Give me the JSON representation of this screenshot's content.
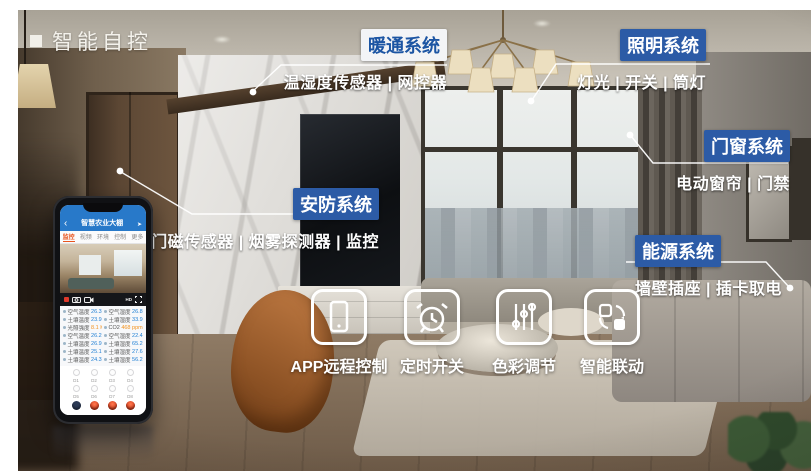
{
  "title": {
    "text": "智能自控"
  },
  "systems": [
    {
      "name": "暖通系统",
      "items": "温湿度传感器 | 网控器",
      "variant": "light"
    },
    {
      "name": "照明系统",
      "items": "灯光 | 开关 | 筒灯",
      "variant": "blue"
    },
    {
      "name": "门窗系统",
      "items": "电动窗帘 | 门禁",
      "variant": "blue"
    },
    {
      "name": "安防系统",
      "items": "门磁传感器 | 烟雾探测器 | 监控",
      "variant": "blue"
    },
    {
      "name": "能源系统",
      "items": "墙壁插座 | 插卡取电",
      "variant": "blue"
    }
  ],
  "features": [
    {
      "icon": "smartphone-icon",
      "label": "APP远程控制"
    },
    {
      "icon": "alarm-clock-icon",
      "label": "定时开关"
    },
    {
      "icon": "sliders-icon",
      "label": "色彩调节"
    },
    {
      "icon": "sync-icon",
      "label": "智能联动"
    }
  ],
  "phone": {
    "header": {
      "back": "‹",
      "title": "智慧农业大棚",
      "action": "➤"
    },
    "tabs": [
      {
        "label": "监控",
        "active": true
      },
      {
        "label": "视频",
        "active": false
      },
      {
        "label": "环境",
        "active": false
      },
      {
        "label": "控制",
        "active": false
      },
      {
        "label": "更多",
        "active": false
      }
    ],
    "controls": {
      "hd_label": "HD"
    },
    "sensors": [
      {
        "l_label": "空气温度",
        "l_value": "26.39 ℃",
        "r_label": "空气湿度",
        "r_value": "26.85 %"
      },
      {
        "l_label": "土壤温度",
        "l_value": "23.98 ℃",
        "r_label": "土壤湿度",
        "r_value": "33.97 %"
      },
      {
        "l_label": "光照强度",
        "l_value": "8.1 Klux",
        "r_label": "CO2",
        "r_value": "468 ppm"
      },
      {
        "l_label": "空气温度",
        "l_value": "26.25 ℃",
        "r_label": "空气湿度",
        "r_value": "22.45 %"
      },
      {
        "l_label": "土壤温度",
        "l_value": "26.98 ℃",
        "r_label": "土壤湿度",
        "r_value": "65.29 %"
      },
      {
        "l_label": "土壤温度",
        "l_value": "25.17 ℃",
        "r_label": "土壤湿度",
        "r_value": "27.67 %"
      },
      {
        "l_label": "土壤温度",
        "l_value": "24.39 ℃",
        "r_label": "土壤湿度",
        "r_value": "56.26 %"
      }
    ],
    "switch_labels_1": [
      "D1",
      "D2",
      "D3",
      "D4"
    ],
    "switch_labels_2": [
      "D5",
      "D6",
      "D7",
      "D8"
    ]
  },
  "colors": {
    "badge_blue": "#2c5ba6",
    "badge_light_bg": "#f3f4f6",
    "badge_light_text": "#1c55a3",
    "phone_header_blue": "#2879c9",
    "tab_active_orange": "#e8541e",
    "value_blue": "#1f7fd4",
    "accent_orange": "#f39320",
    "record_red": "#e0392b",
    "switch_red": "#d63a1a",
    "switch_navy": "#2c3a55"
  }
}
